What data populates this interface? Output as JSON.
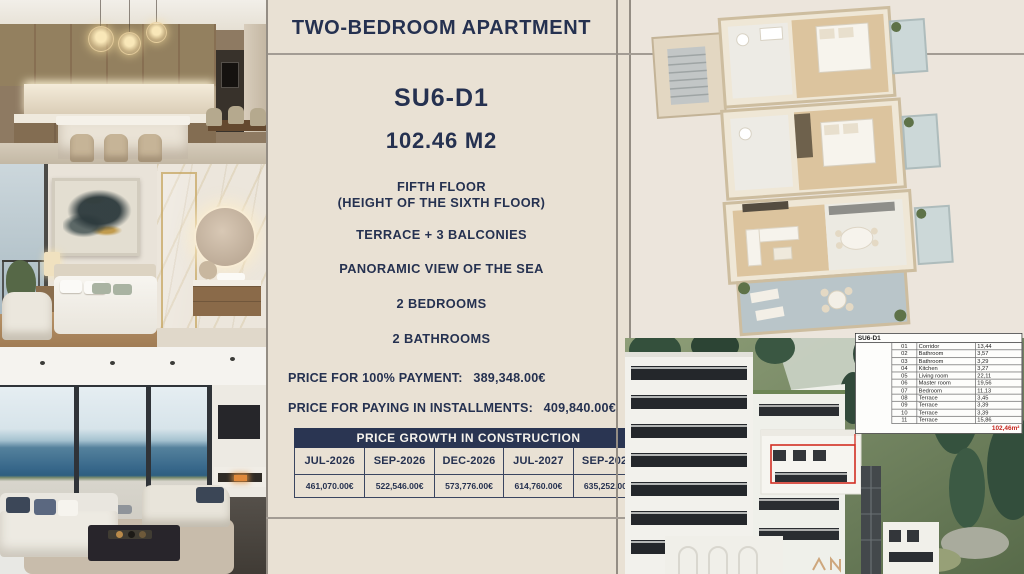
{
  "header": {
    "title": "TWO-BEDROOM APARTMENT"
  },
  "unit": {
    "code": "SU6-D1",
    "area": "102.46 M2",
    "features": [
      "FIFTH FLOOR",
      "(HEIGHT OF THE SIXTH FLOOR)",
      "TERRACE + 3 BALCONIES",
      "PANORAMIC VIEW OF THE SEA",
      "2 BEDROOMS",
      "2 BATHROOMS"
    ]
  },
  "pricing": {
    "full_payment_label": "PRICE FOR 100% PAYMENT:",
    "full_payment_value": "389,348.00€",
    "installments_label": "PRICE FOR PAYING IN INSTALLMENTS:",
    "installments_value": "409,840.00€"
  },
  "price_growth": {
    "title": "PRICE GROWTH IN CONSTRUCTION",
    "columns": [
      "JUL-2026",
      "SEP-2026",
      "DEC-2026",
      "JUL-2027",
      "SEP-2027"
    ],
    "values": [
      "461,070.00€",
      "522,546.00€",
      "573,776.00€",
      "614,760.00€",
      "635,252.00€"
    ]
  },
  "room_table": {
    "header": "SU6-D1",
    "rows": [
      [
        "01",
        "Corridor",
        "13,44"
      ],
      [
        "02",
        "Bathroom",
        "3,57"
      ],
      [
        "03",
        "Bathroom",
        "3,29"
      ],
      [
        "04",
        "Kitchen",
        "3,27"
      ],
      [
        "05",
        "Living room",
        "22,11"
      ],
      [
        "06",
        "Master room",
        "19,56"
      ],
      [
        "07",
        "Bedroom",
        "11,13"
      ],
      [
        "08",
        "Terrace",
        "3,45"
      ],
      [
        "09",
        "Terrace",
        "3,39"
      ],
      [
        "10",
        "Terrace",
        "3,39"
      ],
      [
        "11",
        "Terrace",
        "15,86"
      ]
    ],
    "total": "102,46m²"
  },
  "colors": {
    "navy": "#2a3552",
    "cream_panel": "#e9e1d4",
    "cream_right": "#ece5dc",
    "highlight_red": "#c5251d",
    "rule_grey": "#a39c94"
  }
}
